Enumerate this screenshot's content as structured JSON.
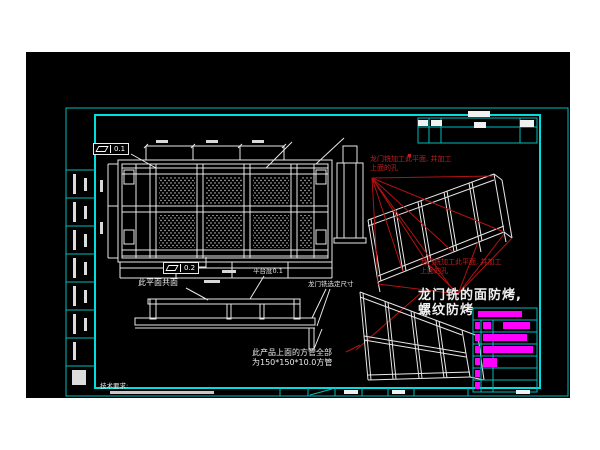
{
  "drawing": {
    "kind": "CAD gantry-frame engineering drawing",
    "colors": {
      "page_bg": "#ffffff",
      "canvas_bg": "#000000",
      "frame_cyan": "#00bdbd",
      "linework_white": "#e8e8e8",
      "annotation_red": "#c41e1e",
      "highlight_magenta": "#ff00ff"
    },
    "gdt": {
      "flatness_top": "0.1",
      "flatness_bottom": "0.2"
    },
    "notes": {
      "red_top_line1": "龙门铣加工此平面, 并加工",
      "red_top_line2": "上面的孔",
      "red_mid_line1": "龙门铣加工此平面, 并加工",
      "red_mid_line2": "上面的孔",
      "coplanar": "此平面共面",
      "flatness_note": "平台度0.1",
      "gantry_dim_note": "龙门铣选定尺寸",
      "anti_bake_line1": "龙门铣的面防烤,",
      "anti_bake_line2": "螺纹防烤",
      "tube_line1": "此产品上面的方管全部",
      "tube_line2": "为150*150*10.0方管",
      "tech_req": "技术要求:"
    }
  }
}
